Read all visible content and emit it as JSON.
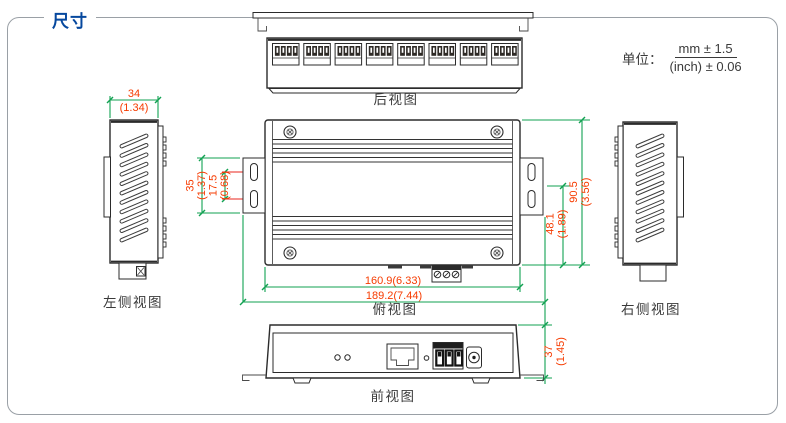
{
  "title": "尺寸",
  "unit_note": {
    "label": "单位：",
    "mm": "mm ± 1.5",
    "inch": "(inch) ± 0.06"
  },
  "views": {
    "rear": {
      "label": "后视图",
      "port_count": 8,
      "pins_per_port": 4
    },
    "left_side": {
      "label": "左侧视图",
      "vent_slot_count": 11
    },
    "top": {
      "label": "俯视图",
      "screw_count": 4,
      "mount_slot_count": 4,
      "terminal_pin_count": 3
    },
    "right_side": {
      "label": "右侧视图",
      "vent_slot_count": 11
    },
    "front": {
      "label": "前视图",
      "led_count": 2,
      "terminal_pin_count": 3
    }
  },
  "dimensions": {
    "side_width": {
      "mm": "34",
      "inch": "(1.34)"
    },
    "mount_ear_height": {
      "mm": "35",
      "inch": "(1.37)"
    },
    "mount_slot_pitch": {
      "mm": "17.5",
      "inch": "(0.68)"
    },
    "body_depth": {
      "mm": "90.5",
      "inch": "(3.56)"
    },
    "slot_to_edge": {
      "mm": "48.1",
      "inch": "(1.89)"
    },
    "body_width": {
      "mm_inch": "160.9(6.33)"
    },
    "overall_width": {
      "mm_inch": "189.2(7.44)"
    },
    "front_height": {
      "mm": "37",
      "inch": "(1.45)"
    }
  },
  "colors": {
    "dimension_line": "#12a152",
    "dimension_text": "#f63b00",
    "centerline_red": "#e8251d",
    "title_blue": "#06489e",
    "outline": "#2b2b2b",
    "frame_border": "#9aa0a6",
    "view_label": "#3a3a3a"
  }
}
